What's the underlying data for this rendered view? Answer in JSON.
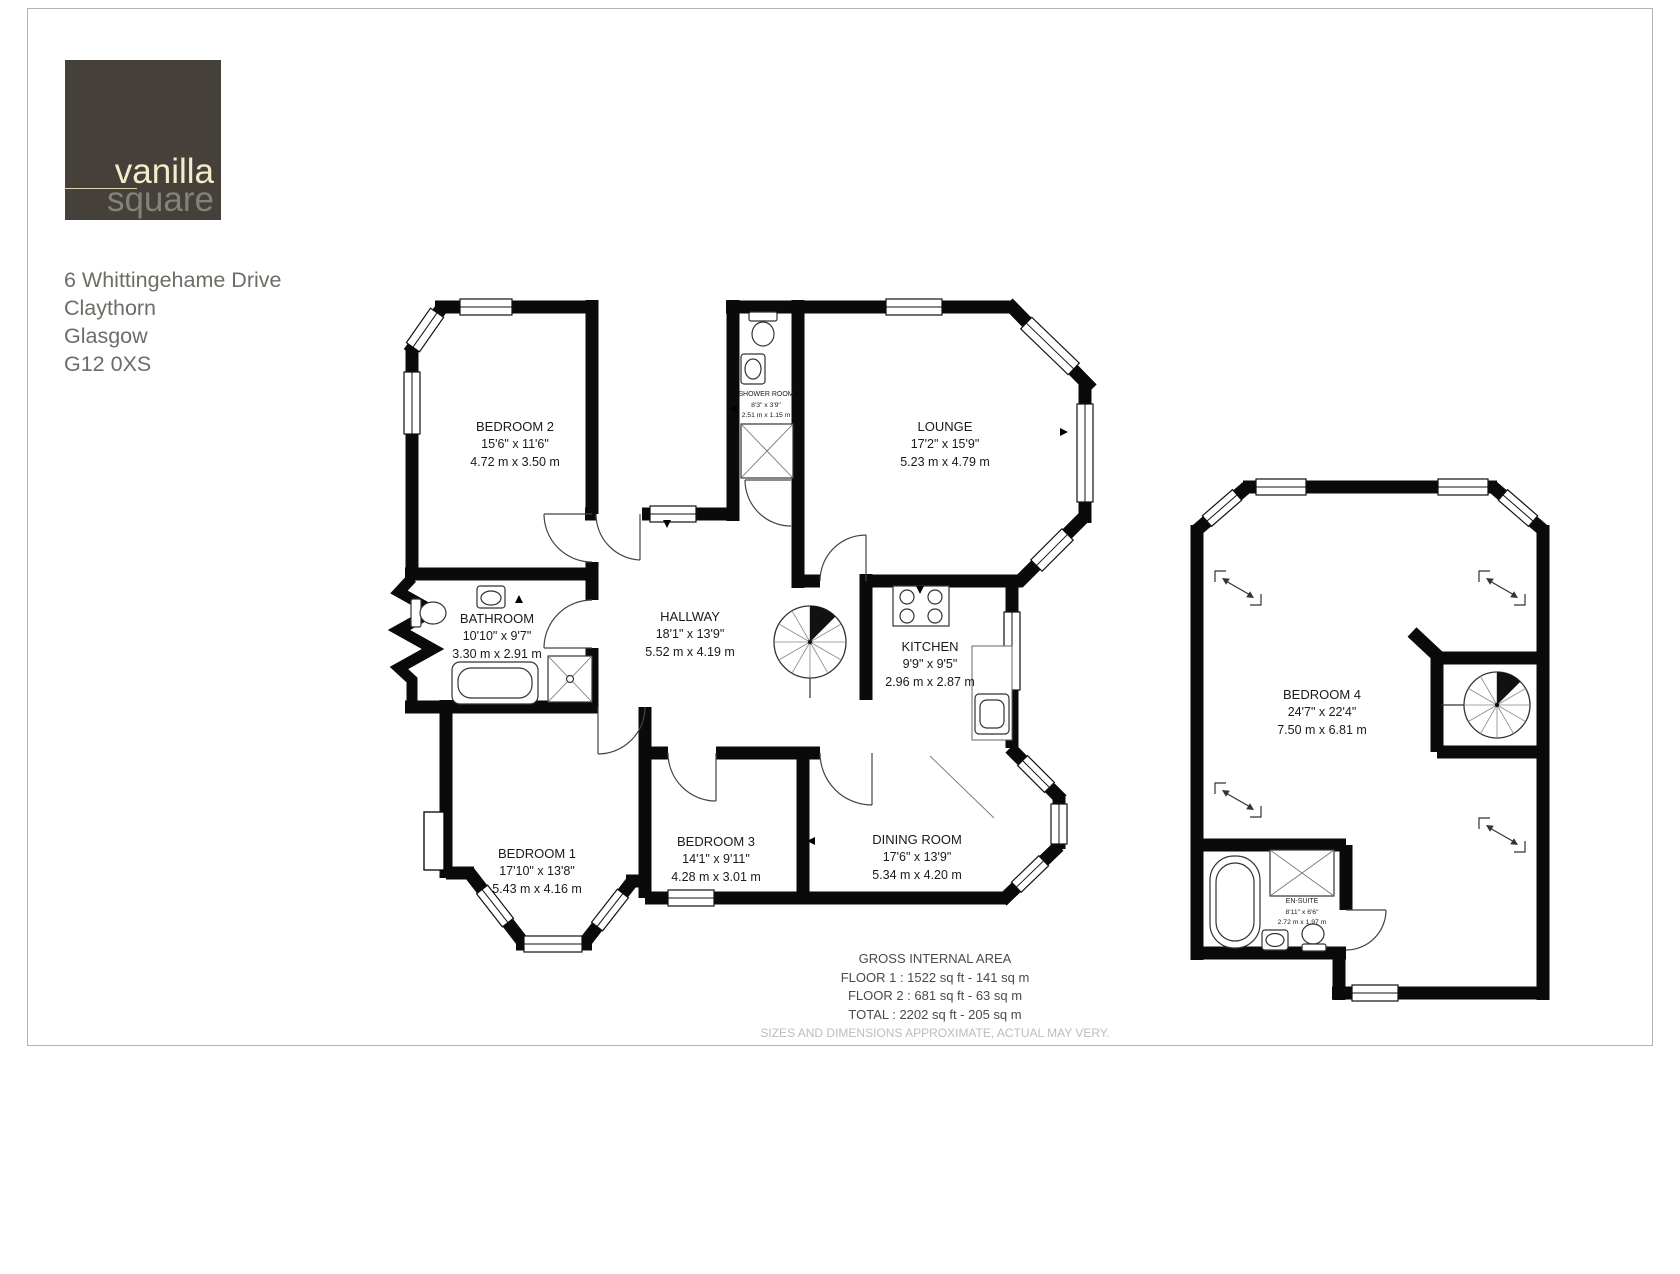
{
  "logo": {
    "word1": "vanilla",
    "word2": "square",
    "bg_color": "#45413a",
    "word1_color": "#f2ecca",
    "word2_color": "#83817b"
  },
  "address": {
    "line1": "6 Whittingehame Drive",
    "line2": "Claythorn",
    "line3": "Glasgow",
    "line4": "G12 0XS"
  },
  "floor1": {
    "rooms": [
      {
        "id": "bedroom-2",
        "name": "BEDROOM 2",
        "imperial": "15'6\" x 11'6\"",
        "metric": "4.72 m x 3.50 m"
      },
      {
        "id": "shower-room",
        "name": "SHOWER ROOM",
        "imperial": "8'3\" x 3'9\"",
        "metric": "2.51 m x 1.15 m"
      },
      {
        "id": "lounge",
        "name": "LOUNGE",
        "imperial": "17'2\" x 15'9\"",
        "metric": "5.23 m x 4.79 m"
      },
      {
        "id": "bathroom",
        "name": "BATHROOM",
        "imperial": "10'10\" x 9'7\"",
        "metric": "3.30 m x 2.91 m"
      },
      {
        "id": "hallway",
        "name": "HALLWAY",
        "imperial": "18'1\" x 13'9\"",
        "metric": "5.52 m x 4.19 m"
      },
      {
        "id": "kitchen",
        "name": "KITCHEN",
        "imperial": "9'9\" x 9'5\"",
        "metric": "2.96 m x 2.87 m"
      },
      {
        "id": "bedroom-1",
        "name": "BEDROOM 1",
        "imperial": "17'10\" x 13'8\"",
        "metric": "5.43 m x 4.16 m"
      },
      {
        "id": "bedroom-3",
        "name": "BEDROOM 3",
        "imperial": "14'1\" x 9'11\"",
        "metric": "4.28 m x 3.01 m"
      },
      {
        "id": "dining-room",
        "name": "DINING ROOM",
        "imperial": "17'6\" x 13'9\"",
        "metric": "5.34 m x 4.20 m"
      }
    ],
    "fixtures": [
      "toilet",
      "sink",
      "shower",
      "bathtub",
      "stove",
      "kitchen-sink",
      "spiral-staircase"
    ]
  },
  "floor2": {
    "rooms": [
      {
        "id": "bedroom-4",
        "name": "BEDROOM 4",
        "imperial": "24'7\" x 22'4\"",
        "metric": "7.50 m x 6.81 m"
      },
      {
        "id": "en-suite",
        "name": "EN-SUITE",
        "imperial": "8'11\" x 6'6\"",
        "metric": "2.72 m x 1.97 m"
      }
    ],
    "fixtures": [
      "bathtub",
      "shower",
      "sink",
      "toilet",
      "spiral-staircase",
      "sloped-ceiling-markers"
    ]
  },
  "footer": {
    "title": "GROSS INTERNAL AREA",
    "floor1_area": "FLOOR 1 : 1522 sq ft - 141 sq m",
    "floor2_area": "FLOOR 2 : 681 sq ft - 63 sq m",
    "total_area": "TOTAL : 2202 sq ft - 205 sq m",
    "disclaimer": "SIZES AND DIMENSIONS APPROXIMATE, ACTUAL MAY VERY."
  },
  "colors": {
    "wall": "#0a0a0a",
    "accent_cream": "#f2ecca",
    "muted_text": "#6e6c66"
  }
}
